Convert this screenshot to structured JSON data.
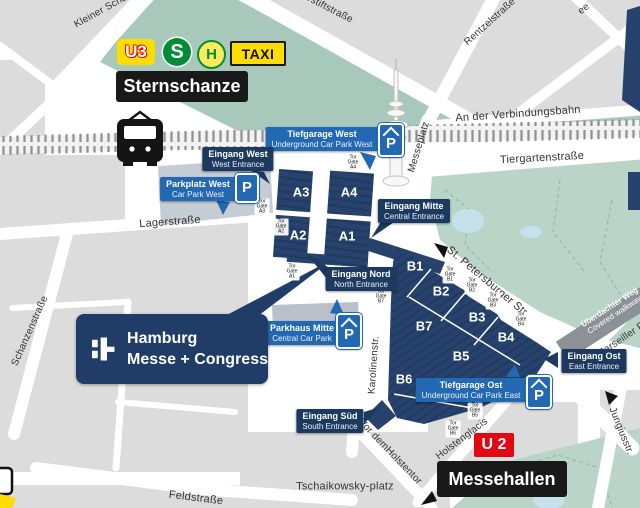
{
  "transit": {
    "u3": "U3",
    "sbahn": "S",
    "bus": "H",
    "taxi": "TAXI",
    "station_north": "Sternschanze",
    "u2": "U 2",
    "station_south": "Messehallen"
  },
  "logo": {
    "name1": "Hamburg",
    "name2": "Messe + Congress"
  },
  "halls": [
    "A3",
    "A4",
    "A2",
    "A1",
    "B1",
    "B2",
    "B3",
    "B4",
    "B5",
    "B6",
    "B7"
  ],
  "gate": {
    "de": "Tor",
    "en": "Gate"
  },
  "gate_ids": [
    "A4",
    "A3",
    "A2",
    "A1",
    "B7",
    "B1",
    "B2",
    "B3",
    "B4",
    "B5",
    "B6"
  ],
  "labels": {
    "tiefgarage_west": {
      "de": "Tiefgarage West",
      "en": "Underground Car Park West"
    },
    "eingang_west": {
      "de": "Eingang West",
      "en": "West Entrance"
    },
    "parkplatz_west": {
      "de": "Parkplatz West",
      "en": "Car Park West"
    },
    "eingang_mitte": {
      "de": "Eingang Mitte",
      "en": "Central Entrance"
    },
    "eingang_nord": {
      "de": "Eingang Nord",
      "en": "North Entrance"
    },
    "parkhaus_mitte": {
      "de": "Parkhaus Mitte",
      "en": "Central Car Park"
    },
    "eingang_ost": {
      "de": "Eingang Ost",
      "en": "East Entrance"
    },
    "tiefgarage_ost": {
      "de": "Tiefgarage Ost",
      "en": "Underground Car Park East"
    },
    "eingang_sued": {
      "de": "Eingang Süd",
      "en": "South Entrance"
    },
    "covered_walkway": {
      "de": "Überdachter Weg",
      "en": "Covered walkway"
    }
  },
  "streets": {
    "kleiner_schaeferkamp": "Kleiner Schäferkamp",
    "schroederstiftstrasse": "Schröderstiftstraße",
    "rentzelstrasse": "Rentzelstraße",
    "unnamed_ne": "ee",
    "an_der_verbindungsbahn": "An der Verbindungsbahn",
    "tiergartenstrasse": "Tiergartenstraße",
    "messeplatz": "Messeplatz",
    "lagerstrasse": "Lagerstraße",
    "schanzenstrasse": "Schanzenstraße",
    "st_petersburger": "St. Petersburger Str.",
    "karolinenstr": "Karolinenstr.",
    "vor_dem_holstentor_1": "Vor dem",
    "vor_dem_holstentor_2": "Holstentor",
    "holstenglacis": "Holstenglacis",
    "jungiusstr": "Jungiusstr.",
    "marseiller": "Marseiller Promenade",
    "feldstrasse": "Feldstraße",
    "tschaikowsky_1": "Tschaikowsky-",
    "tschaikowsky_2": "platz"
  },
  "icons": {
    "parking": "P"
  },
  "colors": {
    "hall_navy": "#27436d",
    "hall_stripe": "#203a60",
    "entrance_navy": "#1c3a5f",
    "parking_blue": "#2268b2",
    "park_green": "#bad5c8",
    "park_green_dark": "#a7c8ba",
    "water": "#c5e2ec",
    "block_gray": "#dcdcdc",
    "street_white": "#ffffff",
    "walkway_gray": "#8b9196",
    "hvv_yellow": "#fddd00",
    "hvv_red": "#e30613",
    "sbahn_green": "#008d36",
    "black_label": "#191919"
  }
}
